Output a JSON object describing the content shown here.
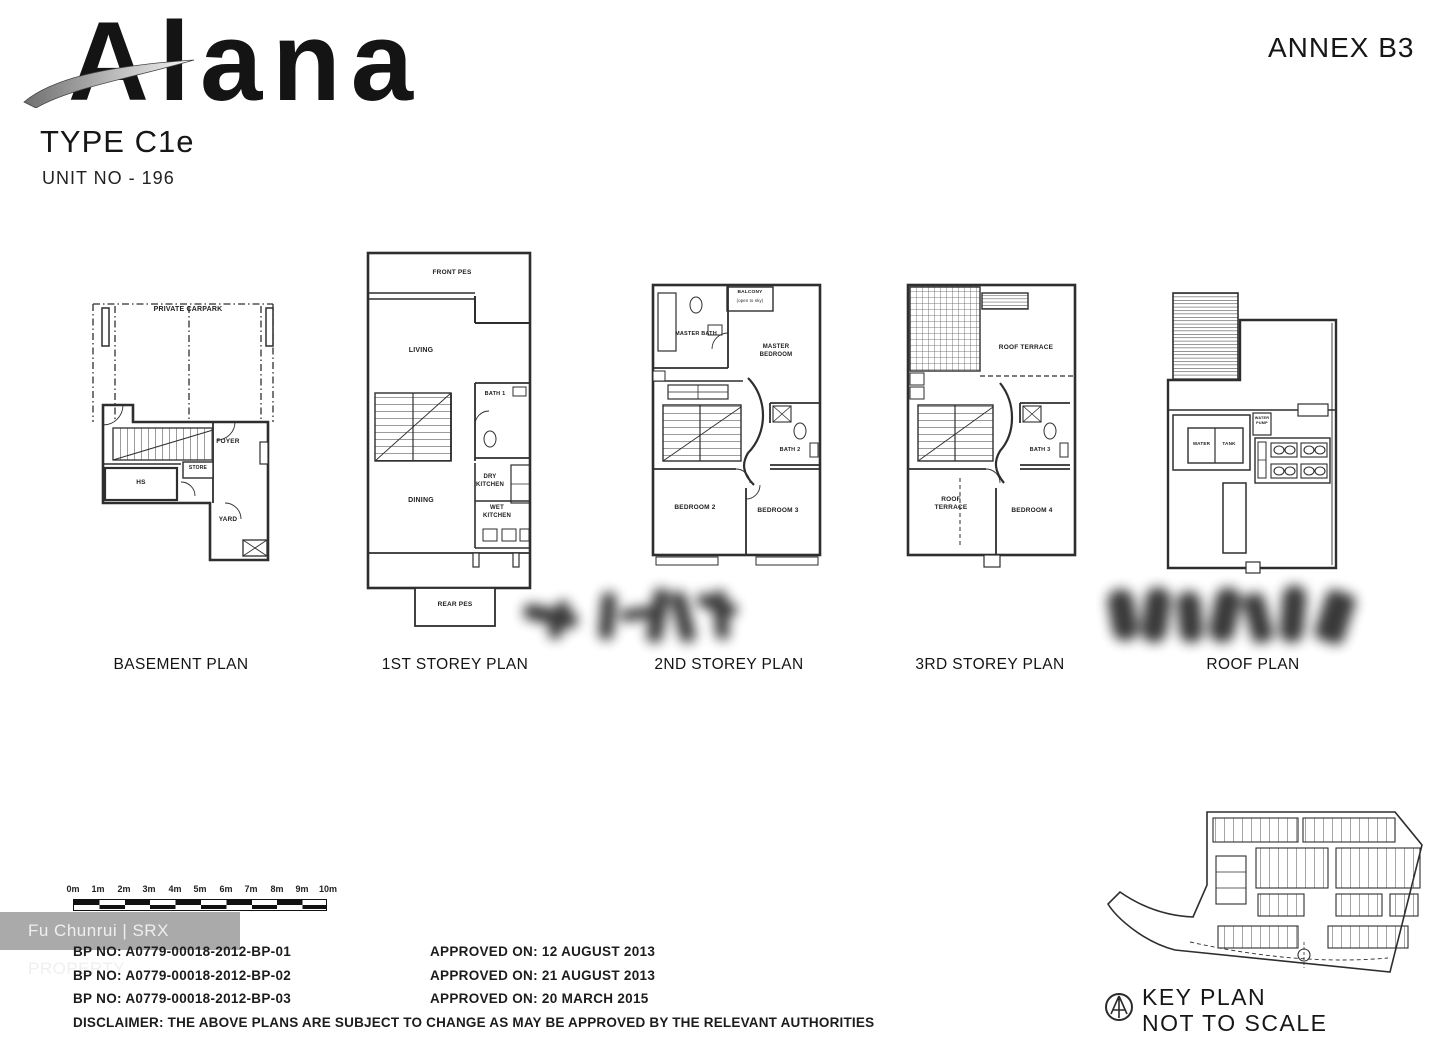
{
  "header": {
    "logo": "Alana",
    "type": "TYPE C1e",
    "unit": "UNIT NO  - 196",
    "annex": "ANNEX B3"
  },
  "plans": {
    "basement": {
      "caption": "BASEMENT PLAN",
      "carpark": "PRIVATE CARPARK",
      "foyer": "FOYER",
      "store": "STORE",
      "hs": "HS",
      "yard": "YARD"
    },
    "first": {
      "caption": "1ST STOREY PLAN",
      "front_pes": "FRONT PES",
      "living": "LIVING",
      "bath1": "BATH 1",
      "dry_kitchen": "DRY KITCHEN",
      "wet_kitchen": "WET KITCHEN",
      "dining": "DINING",
      "rear_pes": "REAR PES"
    },
    "second": {
      "caption": "2ND STOREY PLAN",
      "balcony": "BALCONY",
      "balcony_note": "(open to sky)",
      "master_bath": "MASTER BATH",
      "master_bedroom": "MASTER BEDROOM",
      "bath2": "BATH 2",
      "bedroom2": "BEDROOM 2",
      "bedroom3": "BEDROOM 3"
    },
    "third": {
      "caption": "3RD STOREY PLAN",
      "roof_terrace_upper": "ROOF TERRACE",
      "bath3": "BATH 3",
      "roof_terrace_lower": "ROOF TERRACE",
      "bedroom4": "BEDROOM 4"
    },
    "roof": {
      "caption": "ROOF PLAN",
      "water": "WATER",
      "tank": "TANK",
      "water_pump": "WATER PUMP"
    }
  },
  "scale_bar": {
    "labels": [
      "0m",
      "1m",
      "2m",
      "3m",
      "4m",
      "5m",
      "6m",
      "7m",
      "8m",
      "9m",
      "10m"
    ]
  },
  "approvals": {
    "bp": [
      "BP NO: A0779-00018-2012-BP-01",
      "BP NO: A0779-00018-2012-BP-02",
      "BP NO: A0779-00018-2012-BP-03"
    ],
    "dates": [
      "APPROVED ON: 12 AUGUST 2013",
      "APPROVED ON: 21 AUGUST 2013",
      "APPROVED ON: 20 MARCH 2015"
    ],
    "disclaimer": "DISCLAIMER: THE ABOVE PLANS ARE SUBJECT TO CHANGE AS MAY BE APPROVED BY THE RELEVANT AUTHORITIES"
  },
  "key_plan": {
    "title": "KEY PLAN",
    "subtitle": "NOT TO SCALE"
  },
  "watermark": "Fu Chunrui | SRX PROPERTY"
}
